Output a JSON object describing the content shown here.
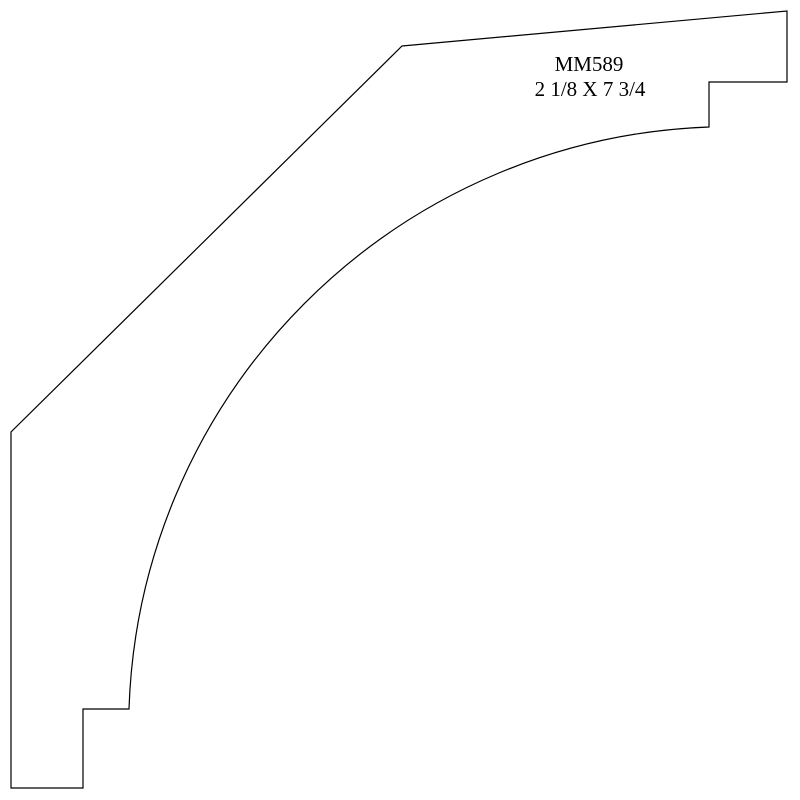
{
  "drawing": {
    "part_number": "MM589",
    "dimensions_label": "2 1/8 X 7 3/4",
    "line_color": "#000000",
    "background_color": "#ffffff"
  }
}
